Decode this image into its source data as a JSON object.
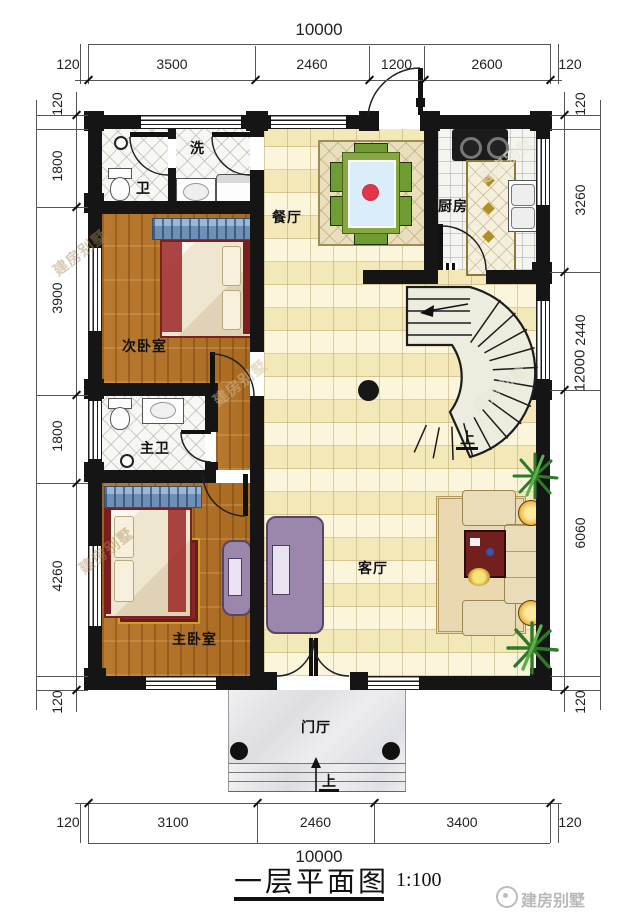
{
  "meta": {
    "title": "一层平面图",
    "scale_label": "1:100",
    "watermark": "建房别墅",
    "up": "上"
  },
  "rooms": {
    "bath": "卫",
    "laundry": "洗",
    "dining": "餐厅",
    "kitchen": "厨房",
    "bedroom2": "次卧室",
    "master_bath": "主卫",
    "master_bedroom": "主卧室",
    "living": "客厅",
    "foyer": "门厅"
  },
  "dimensions": {
    "top": {
      "total": "10000",
      "segments": [
        "120",
        "3500",
        "2460",
        "1200",
        "2600",
        "120"
      ]
    },
    "bottom": {
      "total": "10000",
      "segments": [
        "120",
        "3100",
        "2460",
        "3400",
        "120"
      ]
    },
    "left": {
      "segments": [
        "120",
        "1800",
        "3900",
        "1800",
        "4260",
        "120"
      ]
    },
    "right": {
      "total": "12000",
      "segments": [
        "120",
        "3260",
        "2440",
        "6060",
        "120"
      ]
    }
  },
  "colors": {
    "wall": "#151515",
    "wood_floor": "#b5772e",
    "tile_cream": "#f6eec4",
    "accent_red": "#c22a2a",
    "stair_fill": "#ececdf"
  },
  "footer": {
    "logo_text": "建房别墅"
  }
}
